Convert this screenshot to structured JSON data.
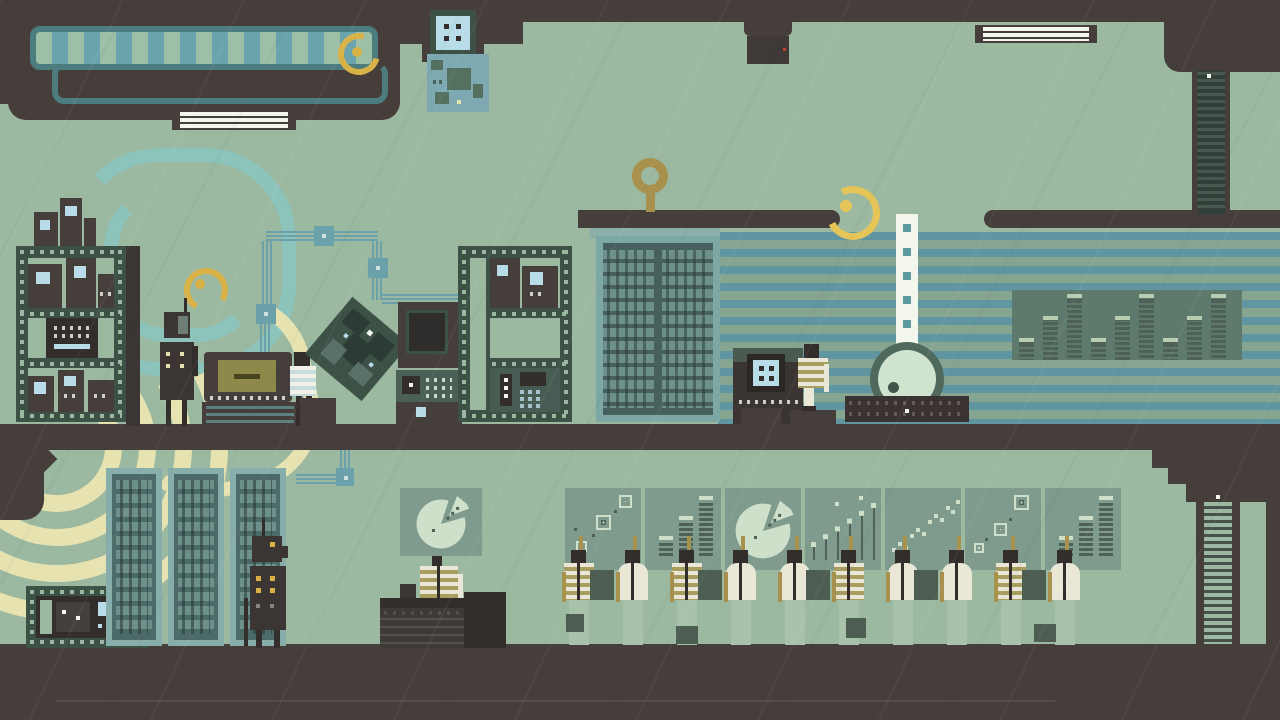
{
  "palette": {
    "bg": "#9bb8a0",
    "dark": "#453e3b",
    "darker": "#332e2b",
    "frame_green": "#3d5146",
    "mid_green": "#4e5d52",
    "panel": "#7e9b8e",
    "chart_dark": "#4d6156",
    "chart_pale": "#cfe0ca",
    "teal_frame": "#7ca7a2",
    "teal_light": "#8cc4bb",
    "teal_wire": "#6ba1aa",
    "stripe_blue": "#5f96a2",
    "stripe_bg": "#86a591",
    "awning_teal": "#4d7c7e",
    "awning_stripe_a": "#9cbfa6",
    "awning_stripe_b": "#6ba3ad",
    "screen_blue": "#b9dde8",
    "pcb_blue": "#7ea9b3",
    "pale_yellow": "#e7e3b1",
    "gold": "#d9b247",
    "gold_bright": "#e6c558",
    "olive_gold": "#a8914d",
    "cream": "#eae7d7",
    "olive_stripe": "#a79d5e",
    "chair_green": "#a9c2ab",
    "white": "#f3f6ec",
    "server_row": "#6d908b",
    "server_body": "#4c6a67",
    "rack_frame": "#87aeab",
    "eq_panel": "#5e7a6d",
    "eq_cap": "#b9cdb3",
    "red": "#c0402f"
  },
  "scene": {
    "description": "pixel-art facility, two floors",
    "upper_floor_objects": [
      "awning",
      "ceiling-camera",
      "hanging-lights",
      "ceiling-scanner",
      "circuit-board",
      "film-rack-left",
      "film-rack-right",
      "robot",
      "typewriter-machine",
      "tilted-circuit-board",
      "machine-stack",
      "server-cabinet",
      "console",
      "striped-press-machine",
      "paper-tape-wheel",
      "key-antenna",
      "signal-spirals"
    ],
    "lower_floor_objects": [
      "film-device",
      "server-racks",
      "robot",
      "pie-presenter",
      "monitor-row",
      "desk-workers",
      "ladders"
    ]
  },
  "big_machine": {
    "equalizer": {
      "values": [
        1,
        2,
        3,
        1,
        2,
        3,
        1,
        2,
        3
      ]
    }
  },
  "monitors": {
    "panels": [
      {
        "type": "square-scatter",
        "points": [
          [
            12,
            54,
            9
          ],
          [
            32,
            28,
            13
          ],
          [
            55,
            8,
            11
          ]
        ],
        "dots": [
          [
            27,
            46
          ],
          [
            49,
            22
          ],
          [
            9,
            40
          ]
        ]
      },
      {
        "type": "bar-stack",
        "values": [
          1,
          2,
          3
        ]
      },
      {
        "type": "pie",
        "slice_gap_deg": [
          16,
          72
        ]
      },
      {
        "type": "lollipop",
        "values": [
          0.25,
          0.4,
          0.55,
          0.7,
          0.85,
          1.0
        ],
        "dots": [
          [
            30,
            14
          ],
          [
            54,
            8
          ]
        ]
      },
      {
        "type": "dot-trail",
        "points": [
          [
            7,
            60
          ],
          [
            13,
            54
          ],
          [
            19,
            58
          ],
          [
            25,
            46
          ],
          [
            31,
            40
          ],
          [
            37,
            44
          ],
          [
            43,
            32
          ],
          [
            49,
            26
          ],
          [
            55,
            30
          ],
          [
            61,
            18
          ],
          [
            66,
            22
          ],
          [
            71,
            12
          ]
        ]
      },
      {
        "type": "square-scatter",
        "points": [
          [
            50,
            8,
            13
          ],
          [
            30,
            36,
            11
          ],
          [
            10,
            56,
            8
          ]
        ],
        "dots": [
          [
            44,
            30
          ],
          [
            20,
            50
          ]
        ]
      },
      {
        "type": "bar-stack",
        "values": [
          1,
          2,
          3
        ]
      }
    ]
  },
  "presenter_sign": {
    "type": "pie",
    "slice_gap_deg": [
      16,
      72
    ]
  },
  "workers": {
    "desk_row": [
      {
        "shirt": "striped",
        "terminal": false
      },
      {
        "shirt": "plain",
        "terminal": true
      },
      {
        "shirt": "striped",
        "terminal": false
      },
      {
        "shirt": "plain",
        "terminal": true
      },
      {
        "shirt": "plain",
        "terminal": false
      },
      {
        "shirt": "striped",
        "terminal": true
      },
      {
        "shirt": "plain",
        "terminal": false
      },
      {
        "shirt": "plain",
        "terminal": true
      },
      {
        "shirt": "striped",
        "terminal": false
      },
      {
        "shirt": "plain",
        "terminal": true
      }
    ],
    "machine_operators": [
      {
        "shirt": "striped-blue",
        "location": "typewriter-machine"
      },
      {
        "shirt": "striped-olive",
        "location": "scanner-console"
      }
    ],
    "presenter": {
      "shirt": "striped-olive",
      "sign": "pie-chart"
    }
  },
  "robots": [
    {
      "location": "upper-floor-shelf"
    },
    {
      "location": "lower-floor-racks"
    }
  ]
}
